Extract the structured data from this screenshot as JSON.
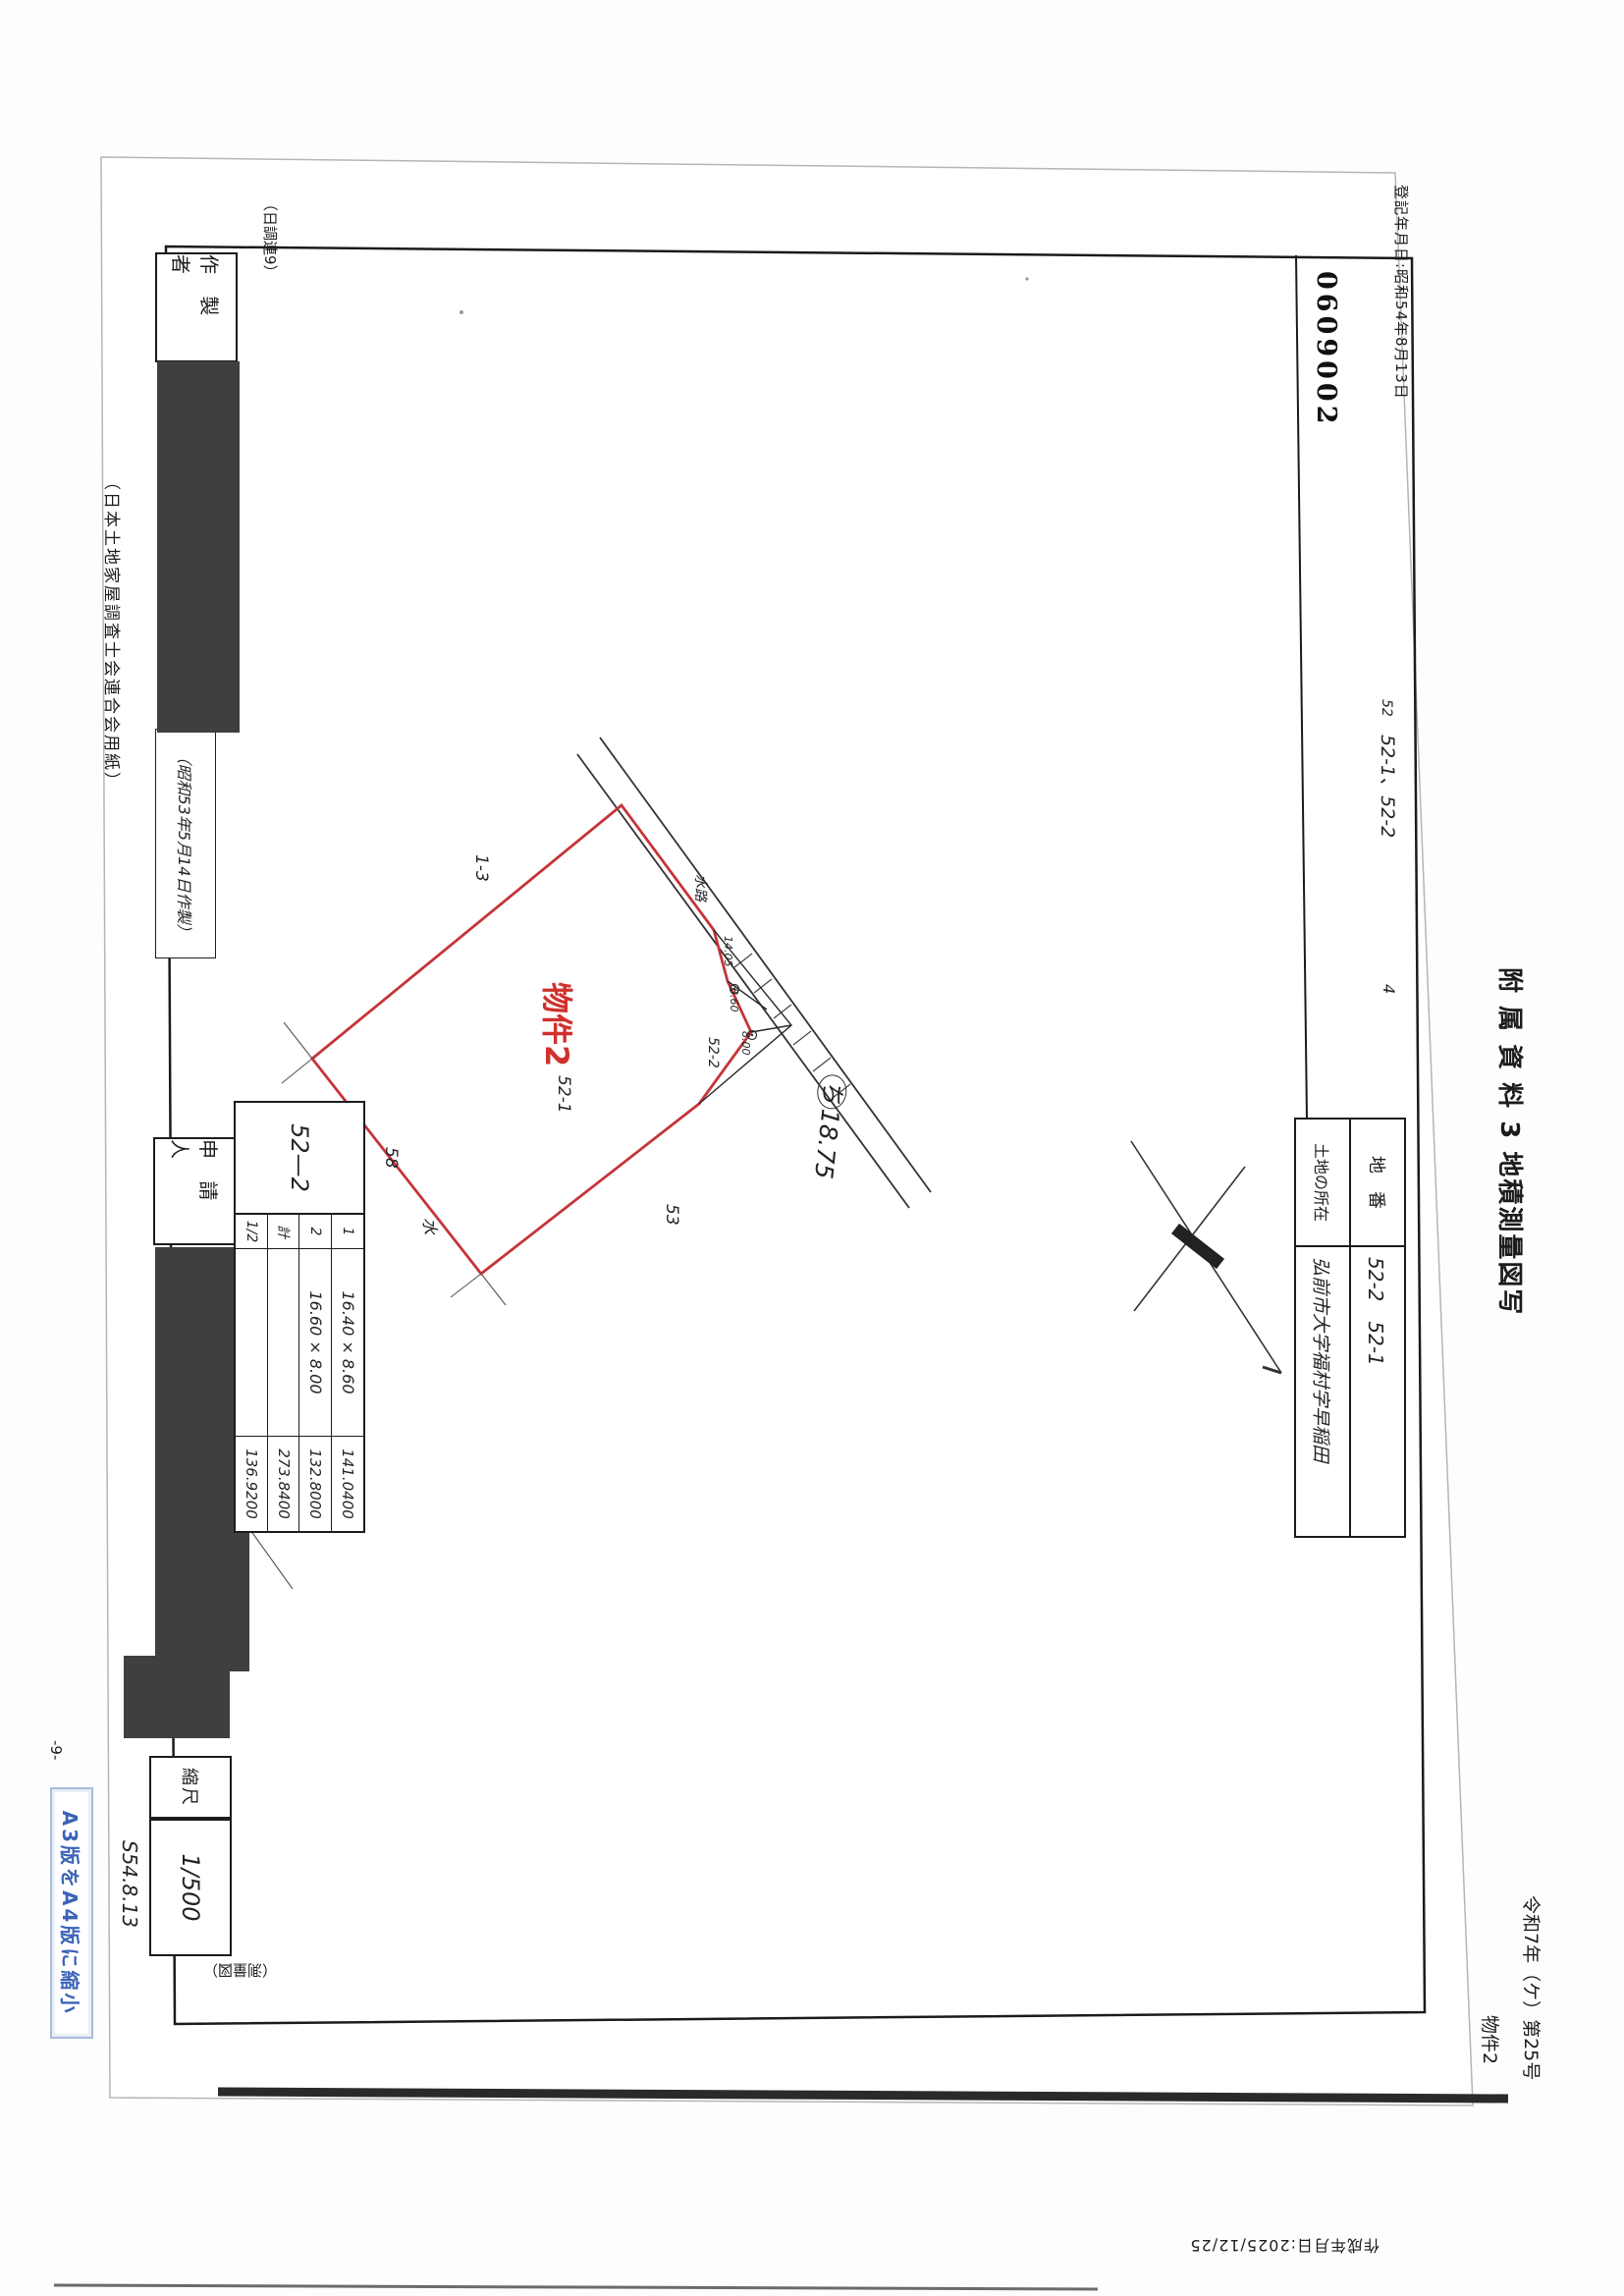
{
  "annotations": {
    "registration_date": "登記年月日:昭和54年8月13日",
    "serial_stamp": "0609002",
    "attachment_title": "附 属 資 料 3  地積測量図写",
    "case_number": "令和7年（ケ）第25号",
    "property_number": "物件2",
    "creation_date": "作成年月日:2025/12/25",
    "page_number": "-9-",
    "reduction_note": "A3版をA4版に縮小",
    "margin_note_prefix": "52",
    "margin_note": "52-1、52-2",
    "margin_note_suffix": "4"
  },
  "form": {
    "form_code": "（日調連9）",
    "paper_note": "（日本土地家屋調査士会連合会用紙）",
    "made_date": "（昭和53年5月14日作製）",
    "preparer_label": "作 製 者",
    "applicant_label": "申 請 人",
    "scale_label": "縮尺",
    "scale_value": "1/500",
    "survey_date_note": "S54.8.13",
    "footer_note": "（測量図）"
  },
  "location_table": {
    "parcel_label": "地　番",
    "parcel_value": "52-2　52-1",
    "address_label": "土地の所在",
    "address_value": "弘前市大字福村字早稲田"
  },
  "area_table": {
    "parcel": "52—2",
    "rows": [
      {
        "no": "1",
        "calc": "16.40 × 8.60",
        "result": "141.0400"
      },
      {
        "no": "2",
        "calc": "16.60 × 8.00",
        "result": "132.8000"
      },
      {
        "no": "計",
        "calc": "",
        "result": "273.8400"
      },
      {
        "no": "1/2",
        "calc": "",
        "result": "136.9200"
      }
    ]
  },
  "map": {
    "property_label": "物件2",
    "parcel_main": "52-1",
    "parcel_sliver": "52-2",
    "parcel_1_3": "1-3",
    "parcel_58": "58",
    "parcel_53": "53",
    "water": "水",
    "waterway": "水路",
    "dim_1405": "14.05",
    "dim_860": "8.60",
    "dim_800": "8.00",
    "point_mark": "ち",
    "point_value": "18.75"
  },
  "colors": {
    "boundary_red": "#c53439",
    "label_red": "#d0312d",
    "note_blue": "#3c63b8",
    "redaction": "#3f3f3f"
  }
}
